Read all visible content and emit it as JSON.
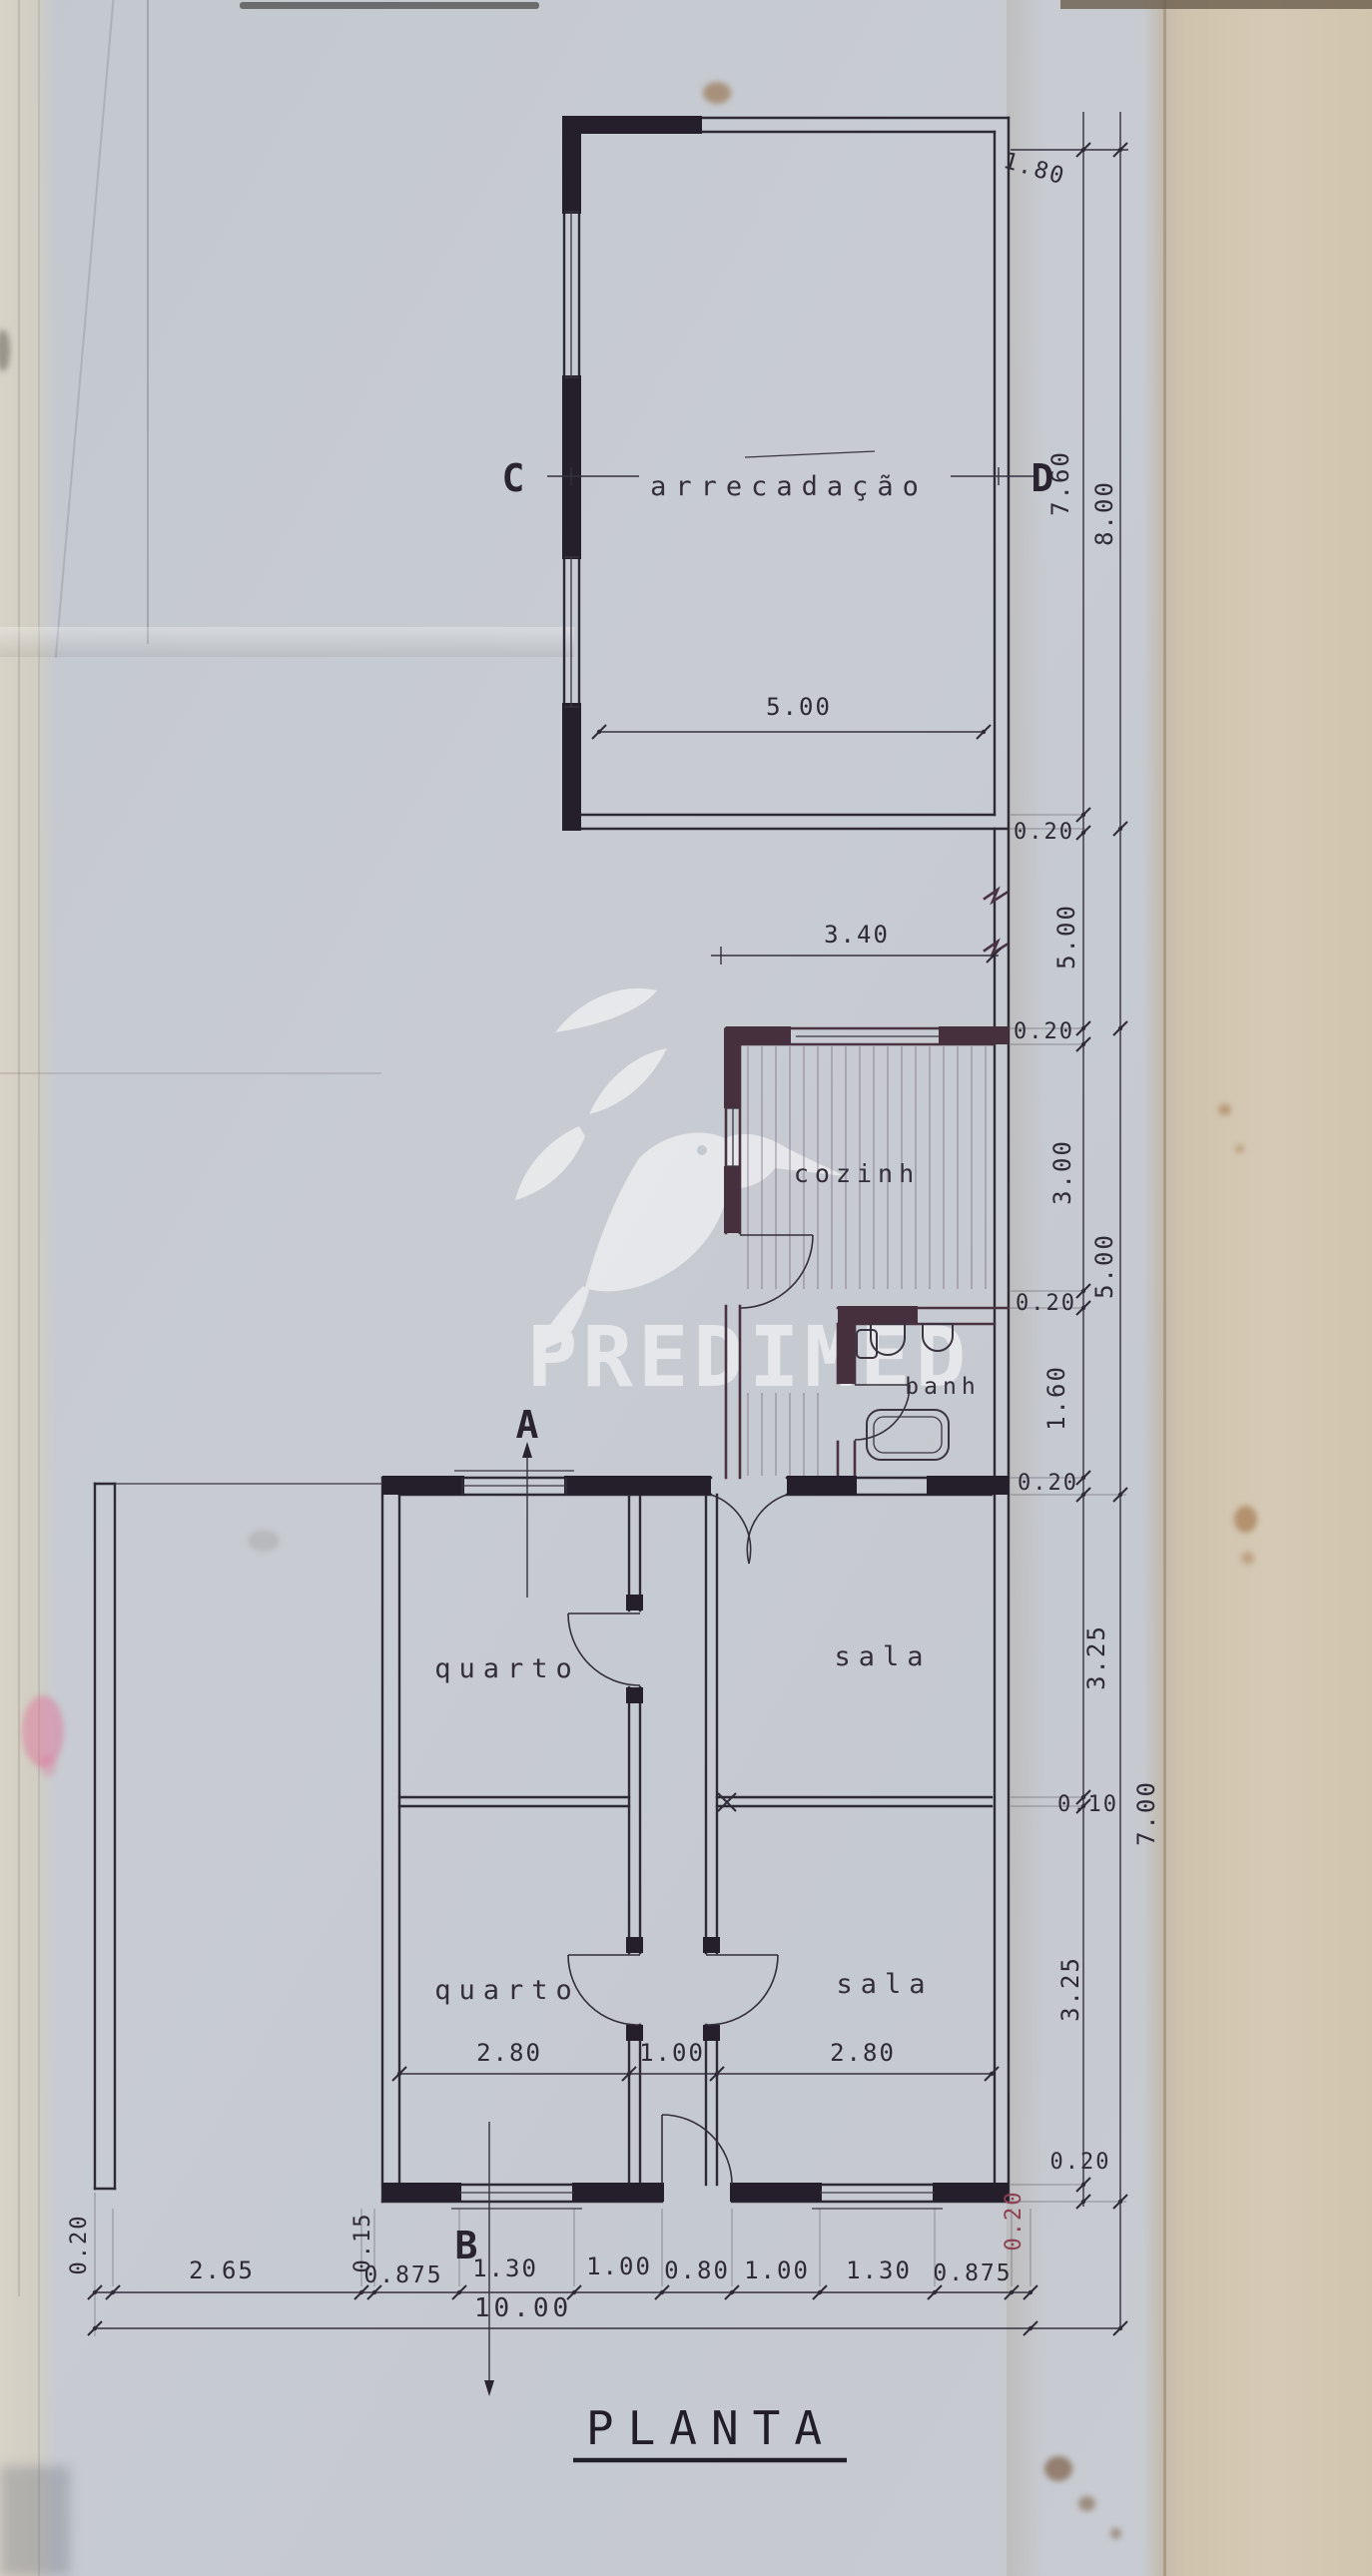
{
  "title": "PLANTA",
  "watermark": {
    "brand": "PREDIMED"
  },
  "markers": {
    "a": "A",
    "b": "B",
    "c": "C",
    "d": "D"
  },
  "rooms": {
    "storage": "arrecadação",
    "kitchen": "cozinh",
    "bath": "banh",
    "bedroom_upper": "quarto",
    "living_upper": "sala",
    "bedroom_lower": "quarto",
    "living_lower": "sala"
  },
  "dims": {
    "top_offset": "1.80",
    "storage_width": "5.00",
    "annex_width": "3.40",
    "right_inner": [
      "7.60",
      "0.20",
      "5.00",
      "0.20",
      "3.00",
      "0.20",
      "1.60",
      "0.20",
      "3.25",
      "0.10",
      "3.25",
      "0.20"
    ],
    "right_outer": [
      "8.00",
      "5.00",
      "7.00"
    ],
    "interior_widths": [
      "2.80",
      "1.00",
      "2.80"
    ],
    "bottom": [
      "0.20",
      "2.65",
      "0.15",
      "0.875",
      "1.30",
      "1.00",
      "0.80",
      "1.00",
      "1.30",
      "0.875",
      "0.20"
    ],
    "total": "10.00"
  },
  "colors": {
    "ink": "#2e2a35",
    "annex_ink": "#4a3340",
    "red_note": "#8d4152",
    "paper": "#c5c9d0",
    "paper_edge": "#cfc2ac"
  }
}
